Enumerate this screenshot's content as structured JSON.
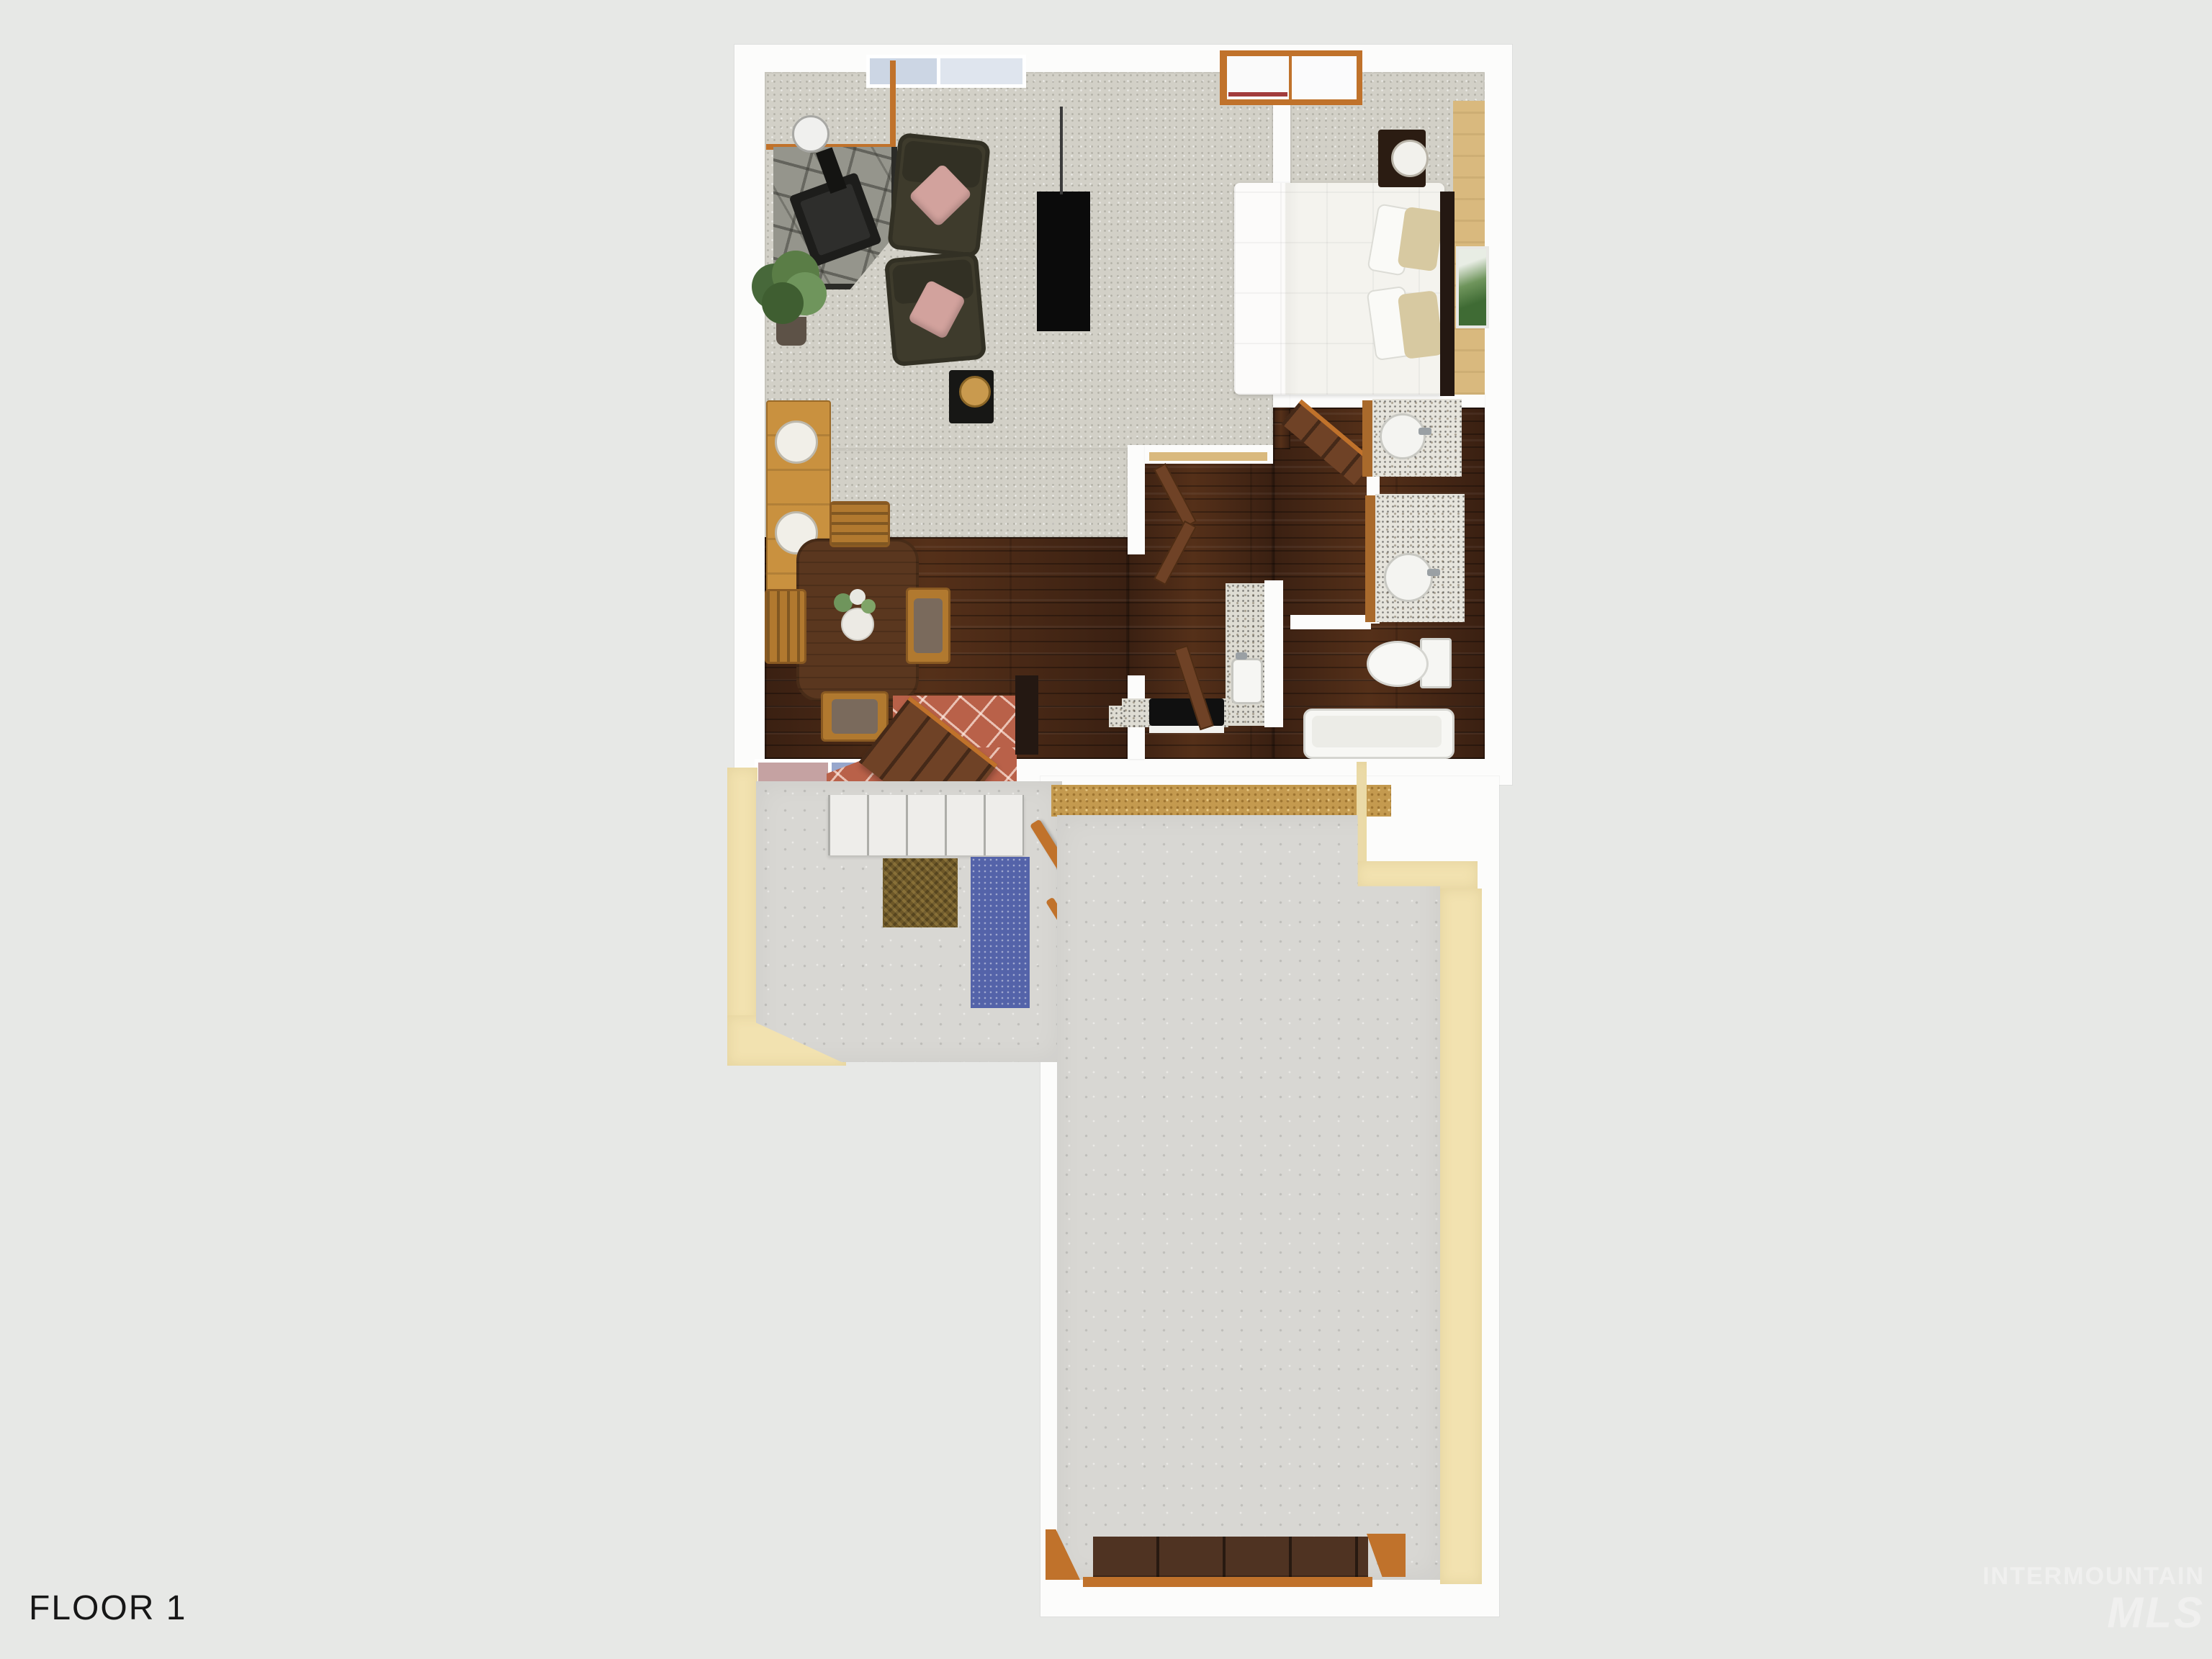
{
  "page": {
    "floor_label": "FLOOR 1"
  },
  "watermark": {
    "line1": "INTERMOUNTAIN",
    "line2": "MLS"
  },
  "colors": {
    "bg": "#e7e8e6",
    "wall": "#fcfcfb",
    "trim": "#c0722b",
    "carpet": "#d2d0c7",
    "wood_dark": "#3a2012",
    "wood_mid": "#553019",
    "tile": "#b96149",
    "concrete": "#d8d7d3",
    "cream": "#f2e2b0",
    "sand": "#c49a4f",
    "stone": "#95958c",
    "sofa": "#3e3b2c",
    "pillow_pink": "#d2a29d",
    "bed_white": "#f4f3ee",
    "pillow_tan": "#d7c9a1",
    "dark_furniture": "#241812",
    "table_wood": "#5a371f",
    "chair_wood": "#b1792f",
    "console_wood": "#c9913f",
    "counter": "#dedcd3",
    "vanity_wood": "#a96a2c",
    "rug_blue": "#5463a9",
    "mat_brown": "#6e5828",
    "door_brown": "#6f4226",
    "garage_door": "#4f3322",
    "accent_wood": "#d9b97e",
    "glass": "#ccd6e4",
    "plant_green": "#5a7d46",
    "text": "#161616",
    "watermark": "#f6f6f5"
  }
}
